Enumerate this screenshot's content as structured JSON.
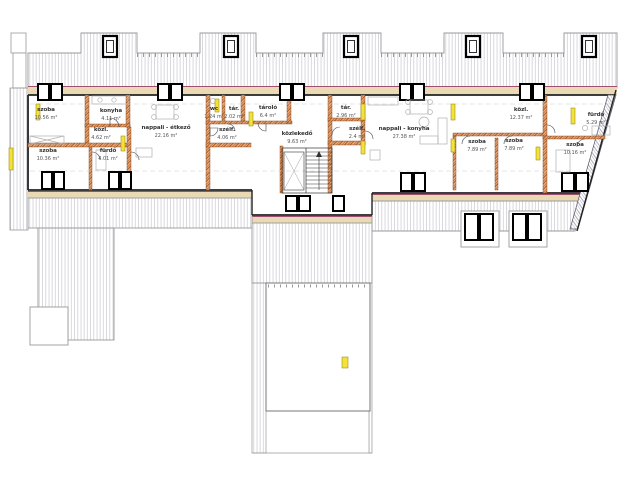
{
  "drawing": {
    "kind": "architectural floor plan (attic storey)",
    "language": "Hungarian"
  },
  "rooms": [
    {
      "name": "szoba",
      "area": "10.56 m²",
      "x": 46,
      "y": 114
    },
    {
      "name": "konyha",
      "area": "4.11 m²",
      "x": 111,
      "y": 115
    },
    {
      "name": "közl.",
      "area": "4.62 m²",
      "x": 101,
      "y": 134
    },
    {
      "name": "szoba",
      "area": "10.36 m²",
      "x": 48,
      "y": 155
    },
    {
      "name": "fürdő",
      "area": "4.01 m²",
      "x": 108,
      "y": 155
    },
    {
      "name": "nappali - étkező",
      "area": "22.16 m²",
      "x": 166,
      "y": 132
    },
    {
      "name": "wc",
      "area": "1.24 m²",
      "x": 214,
      "y": 113
    },
    {
      "name": "tár.",
      "area": "2.02 m²",
      "x": 234,
      "y": 113
    },
    {
      "name": "tároló",
      "area": "6.4 m²",
      "x": 268,
      "y": 112
    },
    {
      "name": "szélf.",
      "area": "4.06 m²",
      "x": 227,
      "y": 134
    },
    {
      "name": "közlekedő",
      "area": "9.63 m²",
      "x": 297,
      "y": 138
    },
    {
      "name": "tár.",
      "area": "2.96 m²",
      "x": 346,
      "y": 112
    },
    {
      "name": "szélf.",
      "area": "2.4 m²",
      "x": 357,
      "y": 133
    },
    {
      "name": "nappali - konyha",
      "area": "27.38 m²",
      "x": 404,
      "y": 133
    },
    {
      "name": "szoba",
      "area": "7.89 m²",
      "x": 477,
      "y": 146
    },
    {
      "name": "szoba",
      "area": "7.89 m²",
      "x": 514,
      "y": 145
    },
    {
      "name": "közl.",
      "area": "12.37 m²",
      "x": 521,
      "y": 114
    },
    {
      "name": "fürdő",
      "area": "5.29 m²",
      "x": 596,
      "y": 119
    },
    {
      "name": "szoba",
      "area": "10.16 m²",
      "x": 575,
      "y": 149
    }
  ],
  "colors": {
    "text-main": "#333333",
    "text-area": "#555555",
    "wall-fill": "#e8a87c",
    "wall-hatch": "#a8581e",
    "roof-line": "#c9c9d2",
    "eave-fill": "#ead9b5",
    "eave-line": "#a0506e",
    "frame": "#000000",
    "highlight": "#f2e23a",
    "furniture": "#b0b0b0"
  }
}
